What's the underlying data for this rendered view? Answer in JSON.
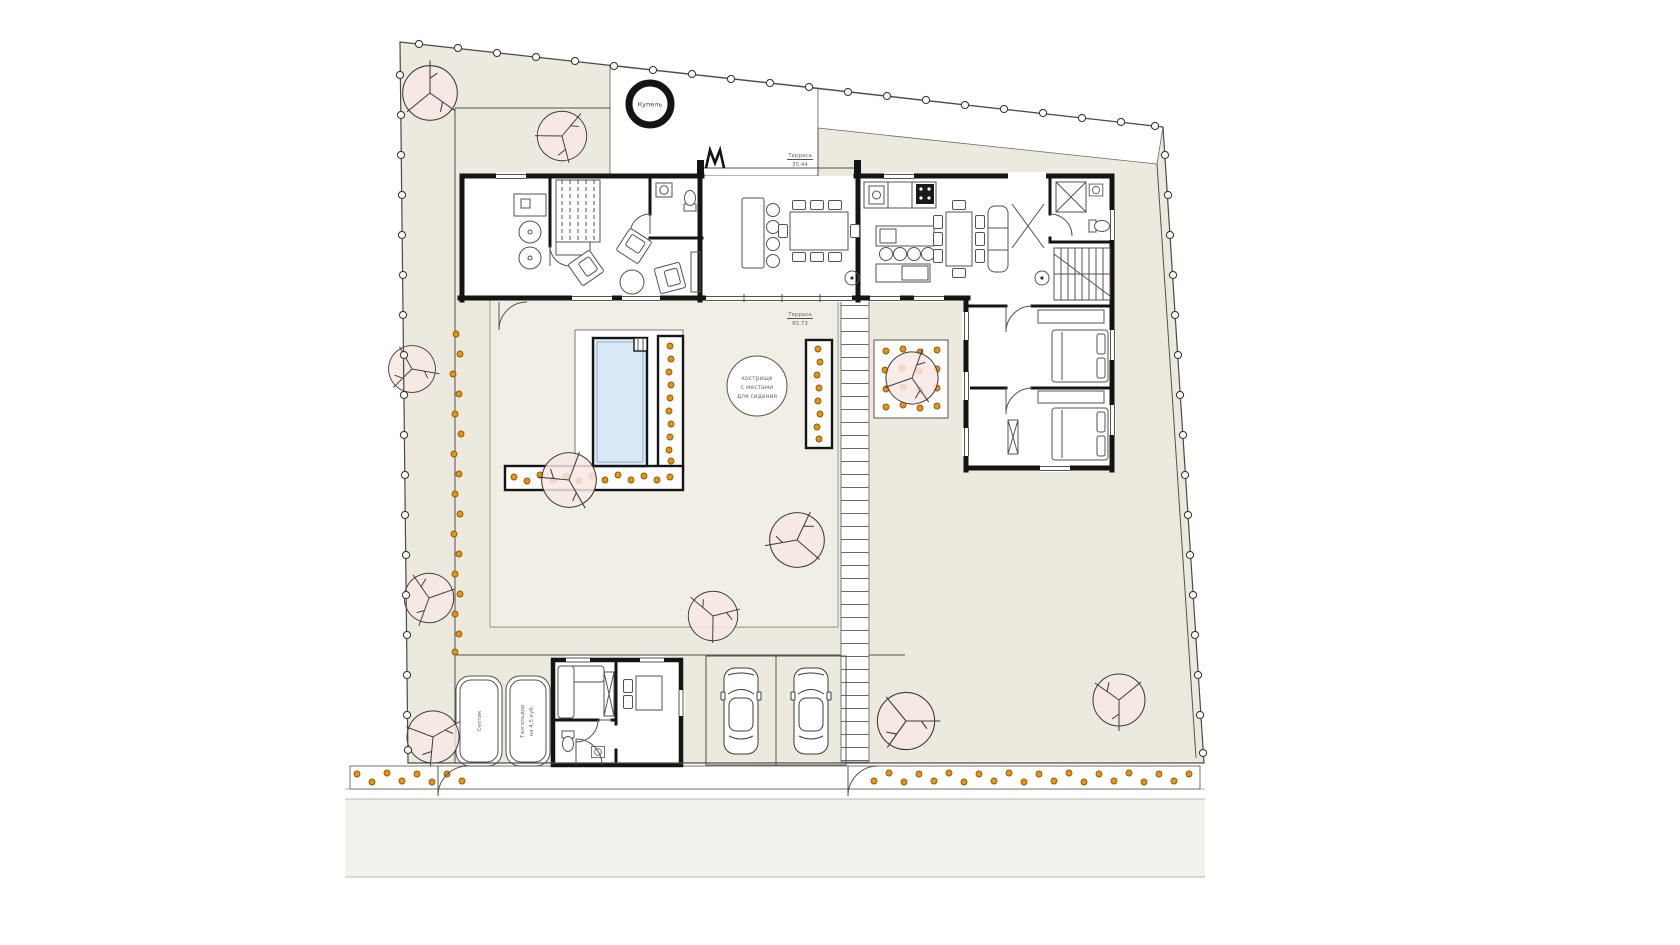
{
  "document": {
    "type": "architectural site and floor plan",
    "labels": {
      "hot_tub": "Купель",
      "terrace_upper": {
        "name": "Терраса",
        "area": "35.44"
      },
      "terrace_main": {
        "name": "Терраса",
        "area": "85.73"
      },
      "fire_pit": {
        "line1": "кострище",
        "line2": "с местами",
        "line3": "для сидения"
      },
      "septic_tank": "Септик",
      "gas_holder": {
        "line1": "Газгольдер",
        "line2": "на 4,5 куб."
      }
    },
    "colors": {
      "ground": "#ECE9DE",
      "courtyard": "#F1EEE6",
      "pool_water": "#D9E9F6",
      "tree_fill": "#F8E8E3",
      "shrub_dot": "#E8930C",
      "wall": "#141414",
      "road": "#F3F1EC"
    }
  }
}
